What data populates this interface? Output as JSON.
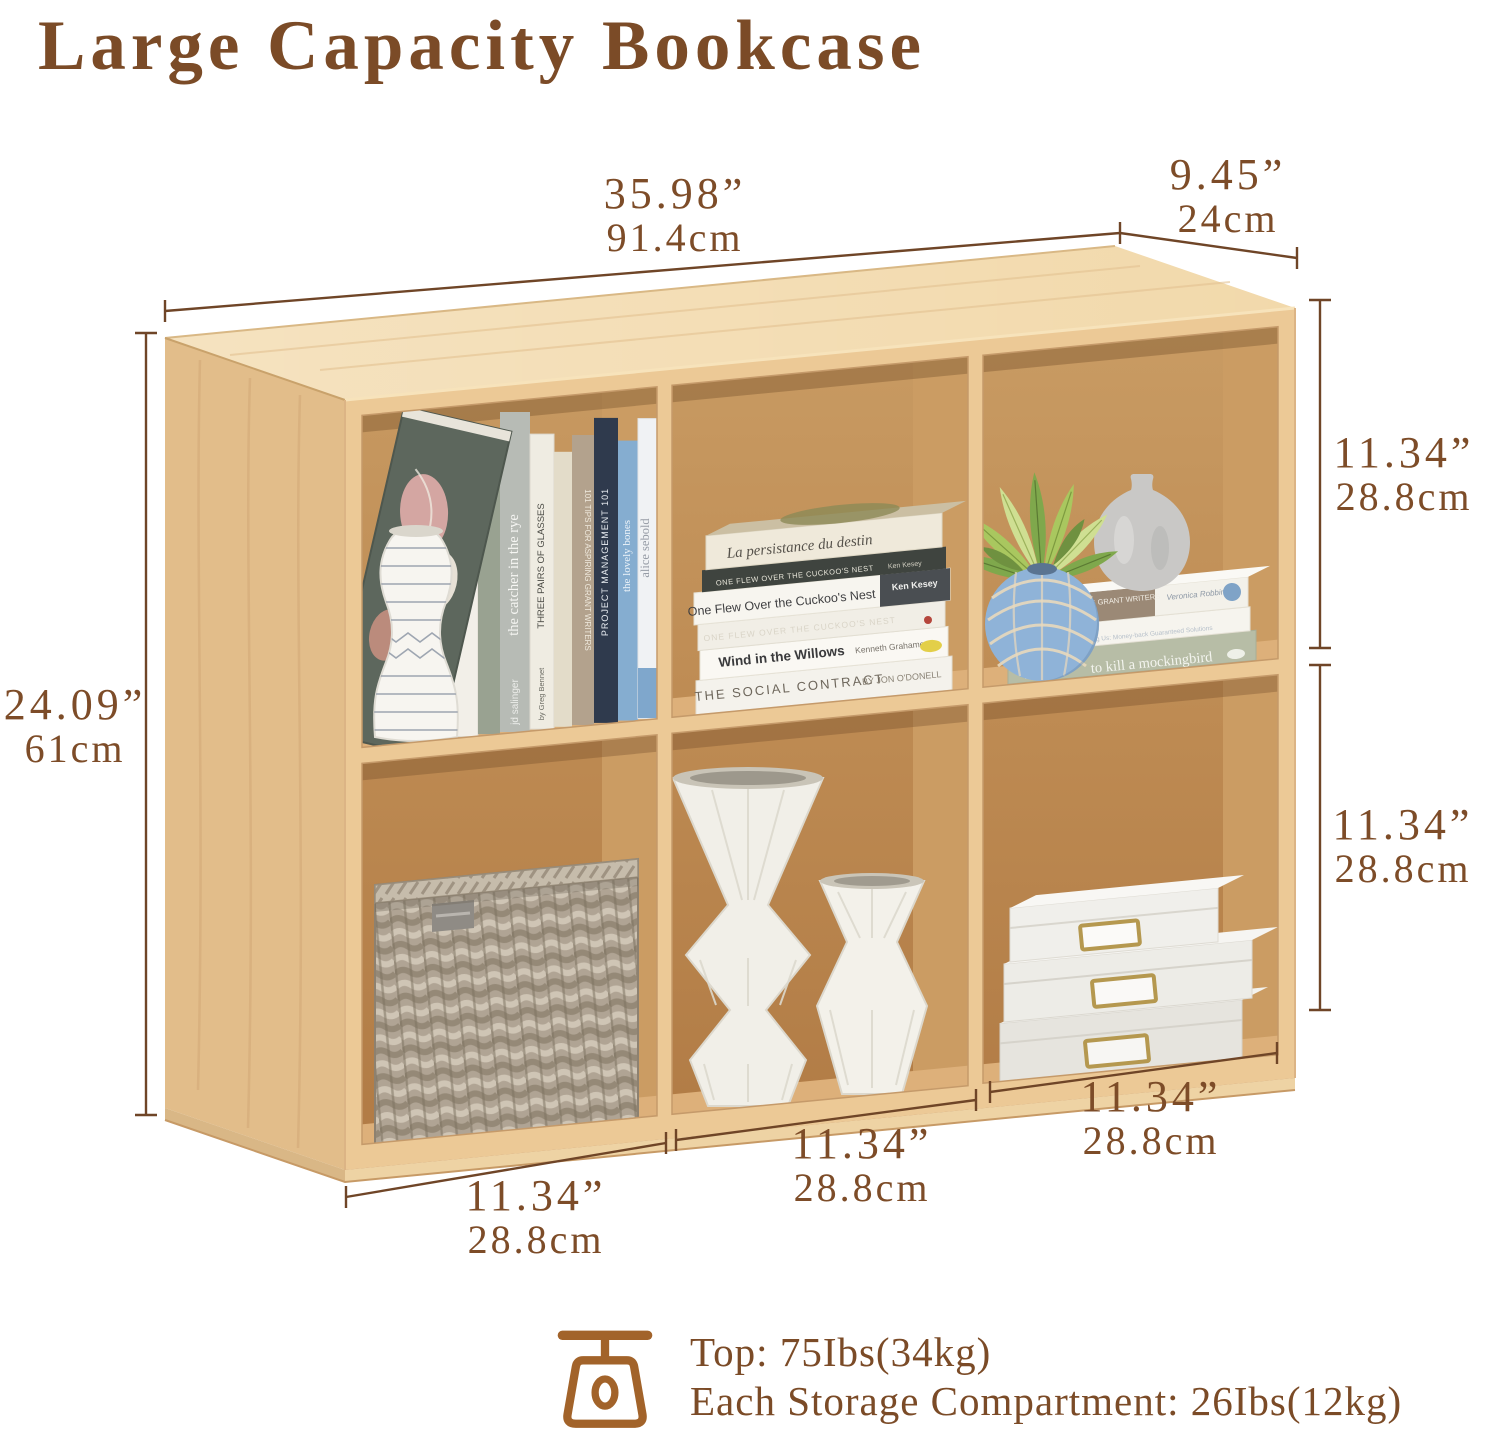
{
  "title": "Large Capacity Bookcase",
  "dimensions": {
    "top_width": {
      "inches": "35.98”",
      "cm": "91.4cm"
    },
    "depth": {
      "inches": "9.45”",
      "cm": "24cm"
    },
    "height": {
      "inches": "24.09”",
      "cm": "61cm"
    },
    "right_top_compartment": {
      "inches": "11.34”",
      "cm": "28.8cm"
    },
    "right_bottom_compartment": {
      "inches": "11.34”",
      "cm": "28.8cm"
    },
    "bottom_left_compartment": {
      "inches": "11.34”",
      "cm": "28.8cm"
    },
    "bottom_middle_compartment": {
      "inches": "11.34”",
      "cm": "28.8cm"
    },
    "bottom_right_compartment": {
      "inches": "11.34”",
      "cm": "28.8cm"
    }
  },
  "capacity": {
    "top_line": "Top: 75Ibs(34kg)",
    "compartment_line": "Each Storage Compartment: 26Ibs(12kg)"
  },
  "books": {
    "spine_persistance": "La persistance du destin",
    "spine_kap": "KAP",
    "spine_catcher": "the catcher in the rye",
    "spine_catcher_author": "jd salinger",
    "spine_glasses": "THREE PAIRS OF GLASSES",
    "spine_glasses_author": "by Greg Bennet",
    "spine_tips": "101 TIPS FOR ASPIRING GRANT WRITERS",
    "spine_pm": "PROJECT MANAGEMENT 101",
    "spine_bones": "the lovely bones",
    "spine_sebold": "alice sebold",
    "stack_persistance": "La persistance du destin",
    "stack_cuckoo_strip": "ONE FLEW OVER THE CUCKOO'S NEST",
    "stack_cuckoo": "One Flew Over the Cuckoo's Nest",
    "stack_cuckoo_author": "Ken Kesey",
    "stack_willows": "Wind in the Willows",
    "stack_willows_author": "Kenneth Grahame",
    "stack_contract": "THE SOCIAL CONTRACT",
    "stack_contract_author": "BY JON O'DONELL",
    "stack_stress": "Our Stress is Killing Us: Money-back Guaranteed Solutions",
    "stack_tips": "101 TIPS FOR ASPIRING GRANT WRITERS",
    "stack_tips_author": "Veronica Robbins",
    "stack_mockingbird": "to kill a mockingbird",
    "stack_mockingbird_author": "harper lee"
  },
  "colors": {
    "accent_text": "#7b4b27",
    "dimension_line": "#6f4527",
    "wood_top": "#f2d9ab",
    "wood_front": "#ecc996",
    "wood_side": "#e2bd8a",
    "wood_interior": "#b8854e",
    "icon": "#a2632a"
  },
  "icons": {
    "capacity": "scale-icon"
  }
}
